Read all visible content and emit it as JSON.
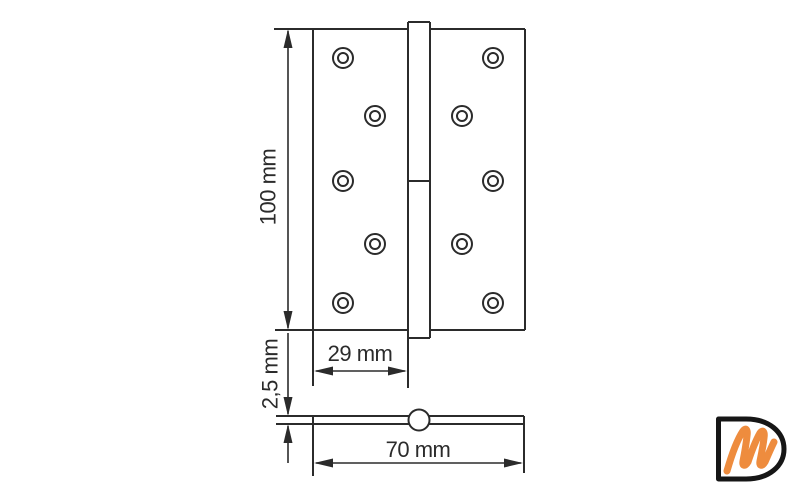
{
  "drawing": {
    "type": "hinge-technical-drawing",
    "dimensions": {
      "height_label": "100 mm",
      "leaf_width_label": "29 mm",
      "thickness_label": "2,5 mm",
      "total_width_label": "70 mm"
    },
    "values_mm": {
      "height": 100,
      "leaf_width": 29,
      "thickness": 2.5,
      "total_width": 70
    },
    "features": {
      "screw_holes": 10,
      "views": [
        "front",
        "bottom-profile"
      ]
    }
  },
  "logo": {
    "letter_d": "D",
    "letter_m": "m"
  },
  "colors": {
    "background": "#ffffff",
    "line": "#2b2b2b",
    "logo_black": "#161616",
    "logo_orange": "#ee8c3e"
  }
}
